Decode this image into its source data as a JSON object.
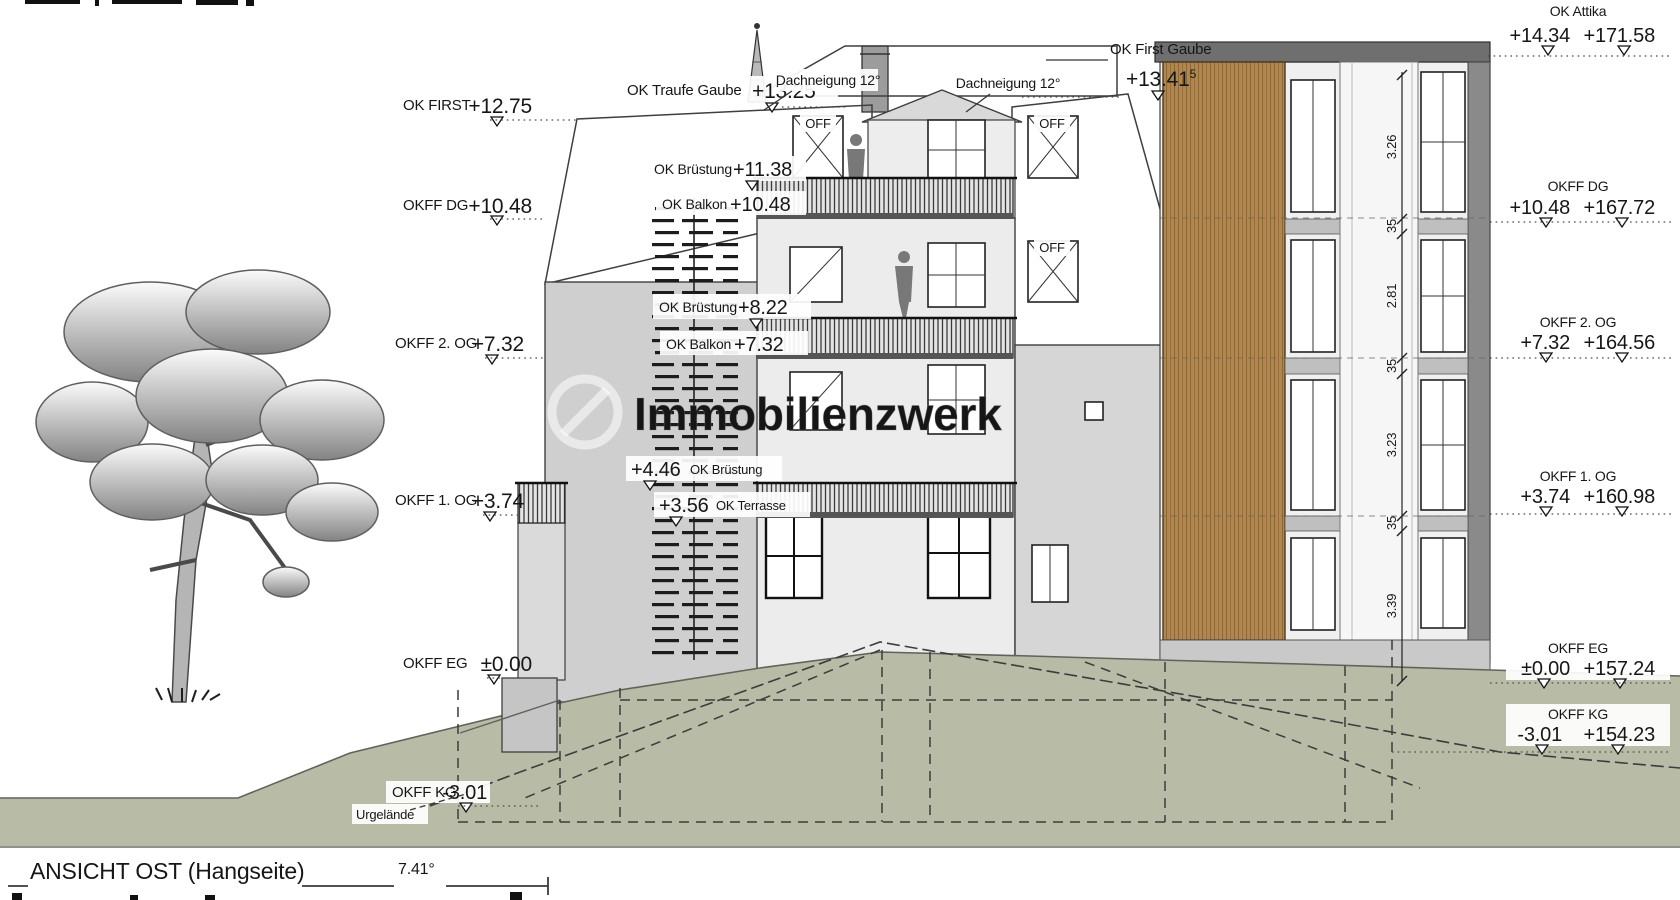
{
  "drawing": {
    "title": "ANSICHT OST (Hangseite)",
    "slope_label": "7.41°",
    "watermark": "Immobilienzwerk",
    "urgelaende_label": "Urgelände"
  },
  "left_levels": [
    {
      "label": "OK FIRST",
      "value": "+12.75"
    },
    {
      "label": "OKFF DG",
      "value": "+10.48"
    },
    {
      "label": "OKFF 2. OG",
      "value": "+7.32"
    },
    {
      "label": "OKFF 1. OG",
      "value": "+3.74"
    },
    {
      "label": "OKFF EG",
      "value": "±0.00"
    },
    {
      "label": "OKFF KG",
      "value": "-3.01"
    }
  ],
  "right_levels": [
    {
      "label": "OK Attika",
      "value": "+14.34",
      "absolute": "+171.58"
    },
    {
      "label": "OKFF DG",
      "value": "+10.48",
      "absolute": "+167.72"
    },
    {
      "label": "OKFF 2. OG",
      "value": "+7.32",
      "absolute": "+164.56"
    },
    {
      "label": "OKFF 1. OG",
      "value": "+3.74",
      "absolute": "+160.98"
    },
    {
      "label": "OKFF EG",
      "value": "±0.00",
      "absolute": "+157.24"
    },
    {
      "label": "OKFF KG",
      "value": "-3.01",
      "absolute": "+154.23"
    }
  ],
  "roof_annotations": {
    "traufe_gaube_label": "OK Traufe Gaube",
    "traufe_gaube_value": "+13.25",
    "first_gaube_label": "OK First Gaube",
    "first_gaube_value": "+13.41",
    "first_gaube_sup": "5",
    "dachneigung_1": "Dachneigung 12°",
    "dachneigung_2": "Dachneigung 12°",
    "dormer_label_1": "OFF",
    "dormer_label_2": "OFF",
    "dormer_label_3": "OFF"
  },
  "facade_annotations": {
    "bruestung_dg_label": "OK Brüstung",
    "bruestung_dg_value": "+11.38",
    "balkon_dg_label": "OK Balkon",
    "balkon_dg_value": "+10.48",
    "bruestung_2og_label": "OK Brüstung",
    "bruestung_2og_value": "+8.22",
    "balkon_2og_label": "OK Balkon",
    "balkon_2og_value": "+7.32",
    "bruestung_1og_value": "+4.46",
    "bruestung_1og_label": "OK Brüstung",
    "terrasse_value": "+3.56",
    "terrasse_label": "OK Terrasse"
  },
  "dimension_chain": [
    "3.26",
    "35",
    "2.81",
    "35",
    "3.23",
    "35",
    "3.39"
  ],
  "colors": {
    "terrain": "#b8bba5",
    "roof": "#cccccc",
    "wood": "#b2874e",
    "accent_dark": "#6f6f6f"
  }
}
